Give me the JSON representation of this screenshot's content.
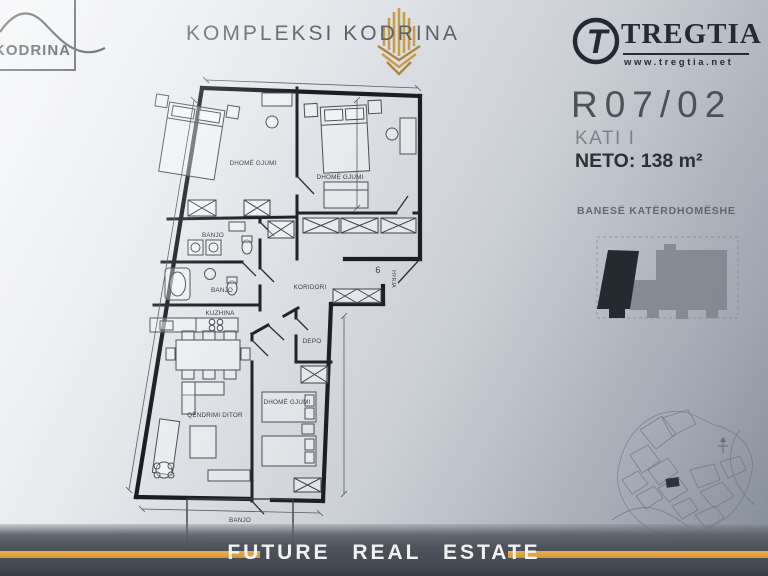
{
  "branding": {
    "kodrina_box_label": "KODRINA",
    "complex_title": "KOMPLEKSI KODRINA",
    "tregtia_name": "TREGTIA",
    "tregtia_monogram": "T",
    "tregtia_url": "www.tregtia.net",
    "footer_brand": "FUTURE REAL ESTATE"
  },
  "unit_info": {
    "code": "R07/02",
    "floor": "KATI I",
    "net_area": "NETO: 138 m²",
    "type": "BANESË KATËRDHOMËSHE"
  },
  "floor_plan_labels": {
    "bedroom_top_left": "DHOMË GJUMI",
    "bedroom_top_right": "DHOMË GJUMI",
    "bedroom_bottom": "DHOMË GJUMI",
    "bathroom_1": "BANJO",
    "bathroom_2": "BANJO",
    "kitchen": "KUZHINA",
    "corridor": "KORIDORI",
    "living_room": "QËNDRIMI DITOR",
    "storage": "DEPO",
    "entrance_number": "6",
    "entrance": "HYRJA",
    "balcony": "BANJO"
  },
  "colors": {
    "gold_accent": "#D8A042",
    "logo_navy": "#232833",
    "plan_ink": "#1a1e24",
    "highlighted_unit": "#23272e",
    "building_gray": "#8f959d"
  }
}
